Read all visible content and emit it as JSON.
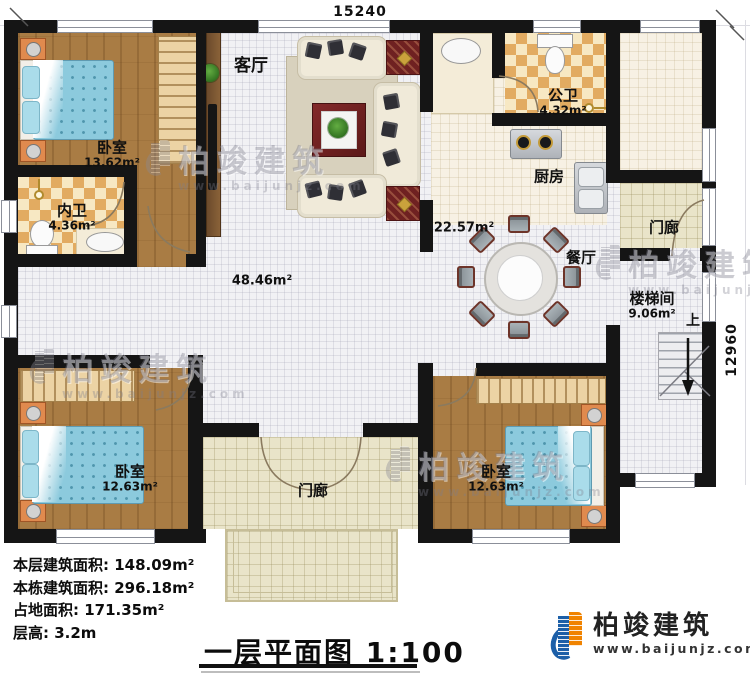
{
  "plan": {
    "dim_top": "15240",
    "dim_right": "12960",
    "rooms": {
      "living": {
        "name": "客厅"
      },
      "bedroom_tl": {
        "name": "卧室",
        "area": "13.62m²"
      },
      "bath_inner": {
        "name": "内卫",
        "area": "4.36m²"
      },
      "bath_public": {
        "name": "公卫",
        "area": "4.32m²"
      },
      "kitchen": {
        "name": "厨房"
      },
      "dining": {
        "name": "餐厅",
        "area": "22.57m²"
      },
      "hall": {
        "area": "48.46m²"
      },
      "porch_right": {
        "name": "门廊"
      },
      "stairwell": {
        "name": "楼梯间",
        "area": "9.06m²",
        "up": "上"
      },
      "bedroom_bl": {
        "name": "卧室",
        "area": "12.63m²"
      },
      "porch_front": {
        "name": "门廊"
      },
      "bedroom_br": {
        "name": "卧室",
        "area": "12.63m²"
      }
    }
  },
  "info": {
    "lines": [
      "本层建筑面积: 148.09m²",
      "本栋建筑面积: 296.18m²",
      "占地面积: 171.35m²",
      "层高: 3.2m"
    ]
  },
  "title": {
    "text": "一层平面图",
    "scale": "1:100"
  },
  "brand": {
    "name": "柏竣建筑",
    "url": "www.baijunjz.com"
  },
  "watermark": {
    "name": "柏竣建筑",
    "url": "www.baijunjz.com"
  },
  "colors": {
    "wall": "#151515",
    "wood": "#a97c44",
    "checker": "#e2ab61",
    "tile": "#f1f1f4",
    "porch": "#e9e4c9",
    "brand_blue": "#1c5fa8",
    "brand_orange": "#f08300",
    "bed": "#8ccadd"
  }
}
